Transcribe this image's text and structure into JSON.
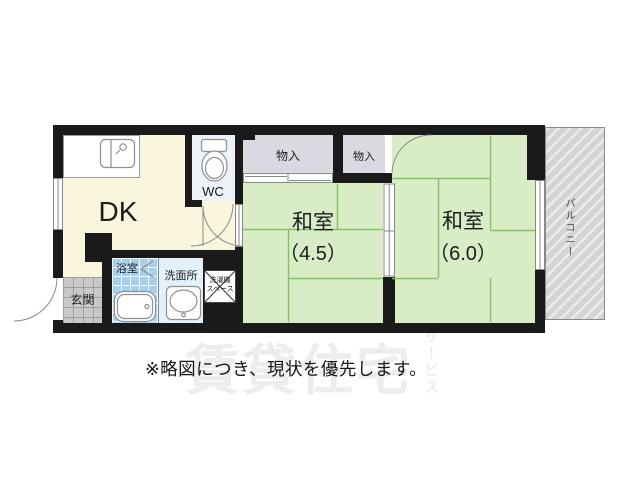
{
  "note": {
    "text": "※略図につき、現状を優先します。"
  },
  "watermark": {
    "main": "賃貸住宅",
    "vertical": "サービス"
  },
  "floorplan": {
    "rooms": {
      "dk": {
        "label": "DK"
      },
      "wc": {
        "label": "WC"
      },
      "closet_left": {
        "label": "物入"
      },
      "closet_right": {
        "label": "物入"
      },
      "washitsu_small": {
        "name": "和室",
        "size": "（4.5）"
      },
      "washitsu_large": {
        "name": "和室",
        "size": "（6.0）"
      },
      "balcony": {
        "label": "バルコニー"
      },
      "genkan": {
        "label": "玄関"
      },
      "bath": {
        "label": "浴室"
      },
      "washroom": {
        "label": "洗面所"
      },
      "laundry": {
        "line1": "洗濯機",
        "line2": "スペース"
      }
    },
    "palette": {
      "wall": "#1a1a1a",
      "tatami": "#d8ecc6",
      "tatami_line": "#84c167",
      "dk_floor": "#faf6dd",
      "closet": "#dcd8e2",
      "wc_floor": "#edf1f8",
      "bath": "#a5d1ee",
      "washroom": "#e3f1fb",
      "genkan": "#c9c9c9",
      "balcony": "#d4d4d4",
      "fixture": "#909090",
      "watermark": "#ededed",
      "note_text": "#151515"
    }
  }
}
